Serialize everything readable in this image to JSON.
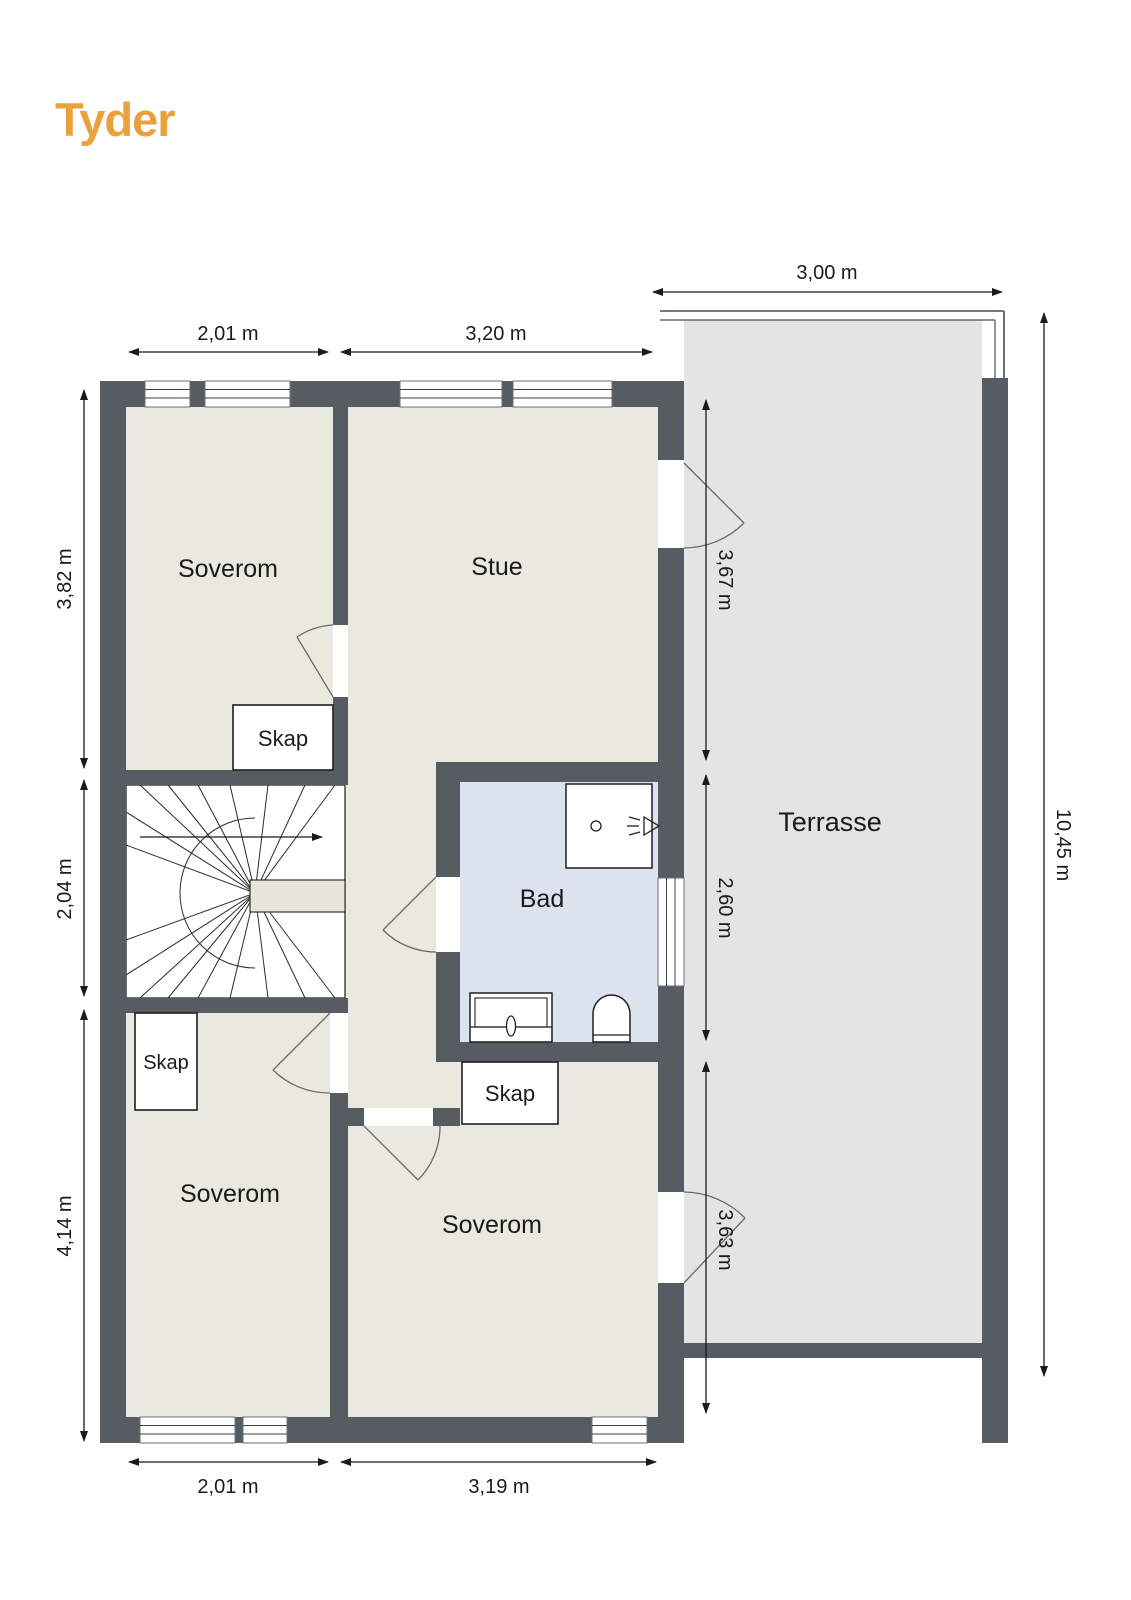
{
  "logo": {
    "text": "Tyder"
  },
  "plan": {
    "rooms": {
      "soverom_top": "Soverom",
      "stue": "Stue",
      "bad": "Bad",
      "soverom_bottom_left": "Soverom",
      "soverom_bottom_middle": "Soverom",
      "terrasse": "Terrasse"
    },
    "closets": {
      "skap_top": "Skap",
      "skap_left": "Skap",
      "skap_middle": "Skap"
    },
    "dimensions": {
      "top_bedroom_width": "2,01 m",
      "top_stue_width": "3,20 m",
      "terrace_width": "3,00 m",
      "left_bedroom_height": "3,82 m",
      "left_stairs_height": "2,04 m",
      "left_lower_bedroom_height": "4,14 m",
      "right_stue_height": "3,67 m",
      "right_bad_height": "2,60 m",
      "right_bedroom_height": "3,63 m",
      "terrace_height": "10,45 m",
      "bottom_bedroom_width": "2,01 m",
      "bottom_middle_width": "3,19 m"
    },
    "colors": {
      "wall": "#575C63",
      "room_floor": "#EAE9DF",
      "terrace_floor": "#E4E4E3",
      "bath_floor": "#DCE2EE",
      "logo": "#E9A23B",
      "dimension_line": "#1A1A1A"
    }
  }
}
